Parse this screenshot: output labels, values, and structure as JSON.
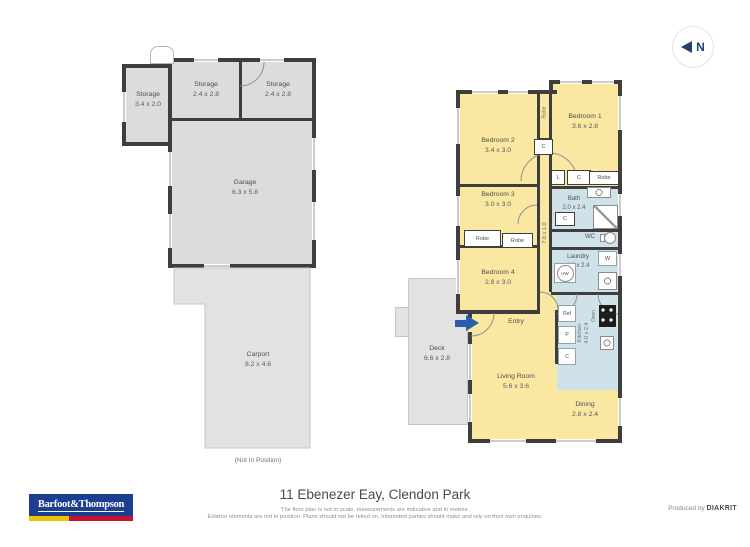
{
  "north": {
    "label": "N"
  },
  "outbuilding": {
    "storage_left": {
      "name": "Storage",
      "dims": "3.4 x 2.0"
    },
    "storage_middle": {
      "name": "Storage",
      "dims": "2.4 x 2.8"
    },
    "storage_right": {
      "name": "Storage",
      "dims": "2.4 x 2.8"
    },
    "garage": {
      "name": "Garage",
      "dims": "6.3 x 5.8"
    },
    "carport": {
      "name": "Carport",
      "dims": "8.2 x 4.6"
    },
    "note": "(Not In Position)"
  },
  "house": {
    "bedroom1": {
      "name": "Bedroom 1",
      "dims": "3.6 x 2.8"
    },
    "bedroom2": {
      "name": "Bedroom 2",
      "dims": "3.4 x 3.0"
    },
    "bedroom3": {
      "name": "Bedroom 3",
      "dims": "3.0 x 3.0"
    },
    "bedroom4": {
      "name": "Bedroom 4",
      "dims": "2.8 x 3.0"
    },
    "bath": {
      "name": "Bath",
      "dims": "2.0 x 2.4"
    },
    "wc": {
      "name": "WC"
    },
    "laundry": {
      "name": "Laundry",
      "dims": "1.6 x 2.4"
    },
    "kitchen": {
      "name": "Kitchen",
      "dims": "4.0 x 2.4"
    },
    "living": {
      "name": "Living Room",
      "dims": "5.6 x 3.6"
    },
    "dining": {
      "name": "Dining",
      "dims": "2.8 x 2.4"
    },
    "entry": {
      "name": "Entry"
    },
    "deck": {
      "name": "Deck",
      "dims": "6.6 x 2.8"
    },
    "hallway_dims": "7.8 x 1.0",
    "fixtures": {
      "robe": "Robe",
      "closet": "C",
      "linen": "L",
      "pantry": "P",
      "washer": "W",
      "hot_water": "HW",
      "fridge": "Ref",
      "oven": "Oven"
    }
  },
  "footer": {
    "brand": "Barfoot&Thompson",
    "address": "11 Ebenezer Eay, Clendon Park",
    "disclaimer1": "The floor plan is not to scale, measurements are indicative and in metres.",
    "disclaimer2": "Exterior elements are not in position. Plans should not be relied on. Interested parties should make and rely on their own enquiries.",
    "produced_by": "Produced by",
    "producer": "DIAKRIT"
  },
  "colors": {
    "room_yellow": "#f9e7a2",
    "wet_blue": "#cfe1e9",
    "garage_gray": "#dcdcdc",
    "exterior_gray": "#e2e2e2",
    "wall": "#3e3e3e",
    "entry_arrow_blue": "#2a5dae",
    "brand_blue": "#1b3e91",
    "brand_yellow": "#eec300",
    "brand_red": "#c41230"
  }
}
